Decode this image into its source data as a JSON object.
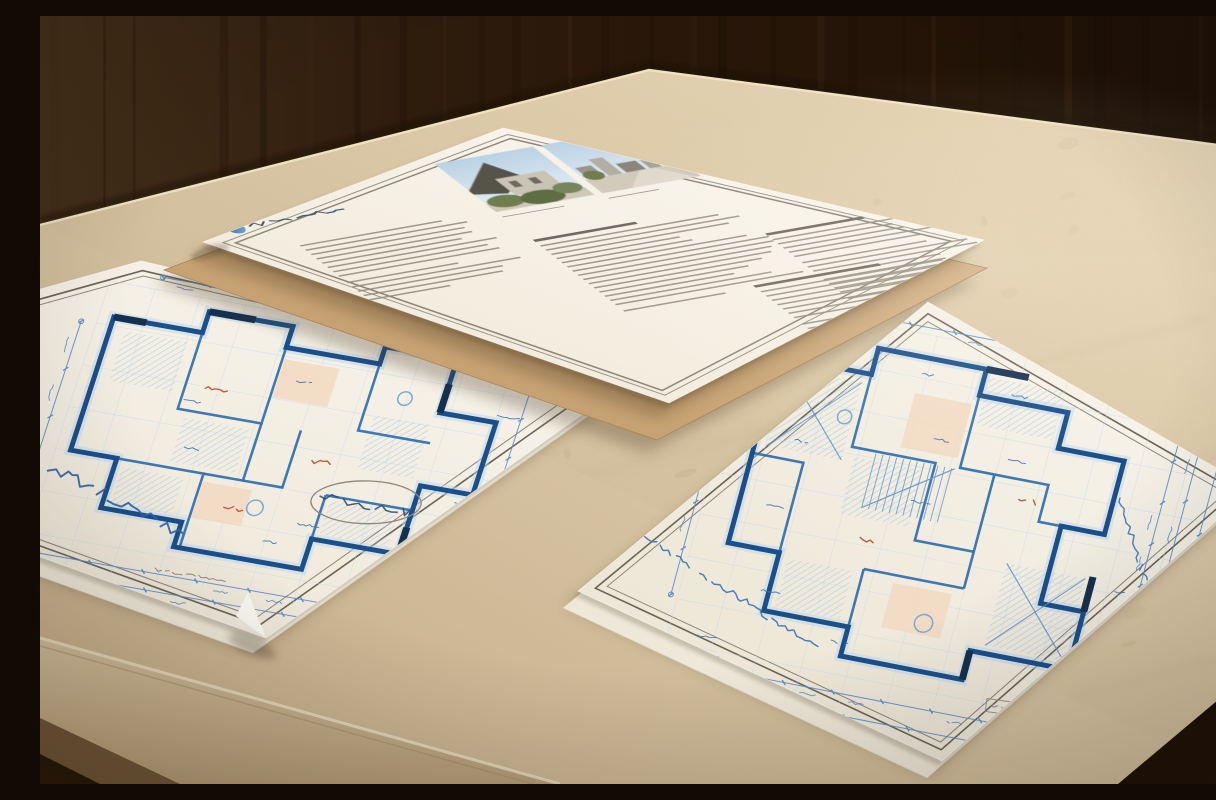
{
  "scene": {
    "caption": "Three printed pages lying on the corner of a beige travertine table in front of a dark wood wall: a white specification sheet with a blue logo and two small house photographs, and two blueprint floor-plan drawings in blue ink, each with double border frames, dimension chains and handwritten-style annotations",
    "objects": [
      "specification-document",
      "kraft-backing-sheet",
      "left-blueprint-sheet",
      "right-blueprint-sheet",
      "travertine-table",
      "wood-wall"
    ]
  },
  "palette": {
    "wall_wood_dark": "#1c0f06",
    "wall_wood_mid": "#2e1c0d",
    "wall_wood_light": "#44301a",
    "table_stone_light": "#ecdcbc",
    "table_stone_mid": "#d5c2a0",
    "table_stone_dark": "#c3ab87",
    "table_speckle": "#a8895f",
    "paper_white": "#f9f6ee",
    "paper_shadowed": "#eae3d1",
    "kraft_paper": "#cda87a",
    "frame_gray_dark": "#6a6456",
    "frame_gray_light": "#8d8678",
    "doc_text_gray": "#8f897c",
    "doc_heading_gray": "#6f6a5f",
    "blueprint_dark": "#1b4f8a",
    "blueprint_mid": "#2a6cae",
    "blueprint_glow": "#bdd7ee",
    "hatch_blue": "#a9c8e4",
    "dimension_blue": "#5b8fc9",
    "note_blue": "#3f76b4",
    "accent_red": "#b5532c",
    "salmon_room": "#f2d8bf",
    "logo_blue": "#2a6cae",
    "photo_sky": "#b9d2e4",
    "shadow_brown": "#46351f"
  },
  "document": {
    "name": "spec-sheet",
    "logo_word_length": 95,
    "photo_count": 2,
    "columns": [
      {
        "lines": 13,
        "heading": false
      },
      {
        "lines": 17,
        "heading": true
      },
      {
        "lines": 15,
        "heading": true
      }
    ],
    "footer_lines": 12
  },
  "left_blueprint": {
    "name": "floor-plan-left",
    "dimension_chains": 5,
    "margin_notes": 3,
    "has_signature_oval": true,
    "hatched_rooms": 5,
    "tinted_rooms": 2,
    "annotation_count": 9
  },
  "right_blueprint": {
    "name": "floor-plan-right",
    "dimension_chains": 7,
    "margin_notes": 4,
    "has_title_block": true,
    "hatched_rooms": 5,
    "tinted_rooms": 2,
    "annotation_count": 14
  }
}
